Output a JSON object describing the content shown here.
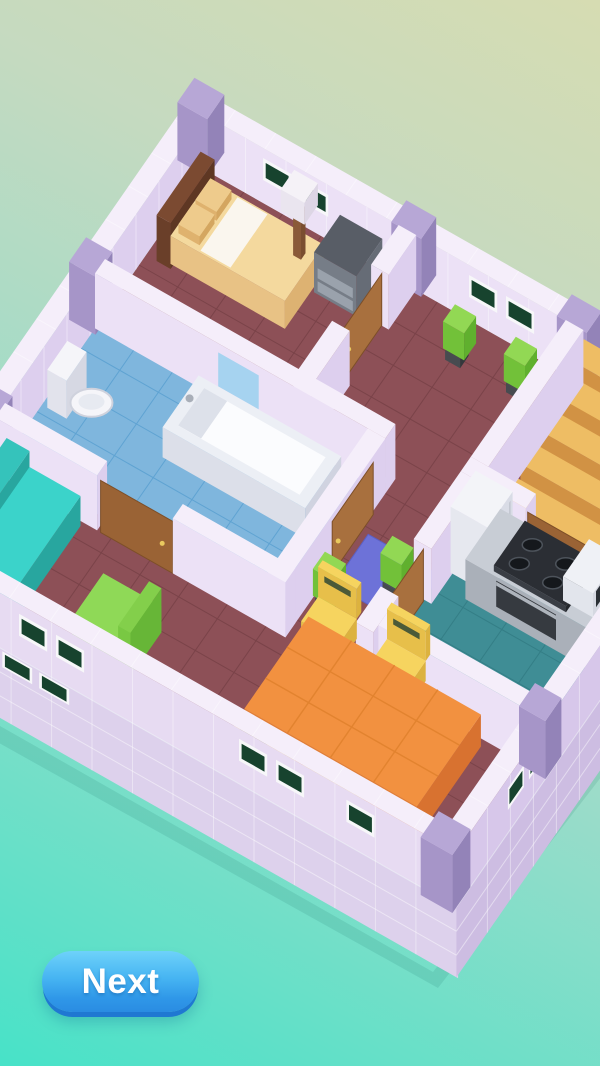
{
  "button": {
    "label": "Next",
    "text_color": "#ffffff",
    "top_color": "#6ed2fa",
    "bottom_color": "#2a8ce2",
    "shadow_color": "#1f78d2"
  },
  "background": {
    "top": "#d6dcb2",
    "mid": "#c5dac0",
    "bottom": "#47e2c8"
  },
  "scene": {
    "name": "isometric-house-floorplan",
    "objects": [
      "bed",
      "pillow",
      "table-lamp",
      "dresser",
      "door",
      "window",
      "plant",
      "stairs",
      "toilet",
      "bathtub",
      "bath-window",
      "sofa",
      "tv",
      "armchair",
      "rug",
      "fridge",
      "kitchen-counter",
      "stove",
      "microwave",
      "dining-table",
      "dining-chair"
    ],
    "colors": {
      "wallTop": "#f5eefa",
      "wallU": "#ece1f6",
      "wallV": "#ddcfee",
      "wallOuterU": "#e7dbf2",
      "wallOuterV": "#d7c7ea",
      "baseU": "#ddd1ec",
      "baseV": "#cdbde2",
      "baseLine": "rgba(255,255,255,0.45)",
      "grout": "rgba(255,255,255,0.40)",
      "capTop": "#b7a7d6",
      "capSide": "#a695c8",
      "capSideDark": "#9383b8",
      "floor": "#8d5057",
      "floorLine": "#7a4349",
      "bathFloor": "#7fb6dd",
      "bathLine": "#5fa3d2",
      "kitFloor": "#3f8d95",
      "kitLine": "#347e86",
      "windowFrame": "#f7f7f9",
      "windowGlass": "#17432e",
      "bathWindow": "#a6d3f0",
      "door": "#a8703e",
      "doorB": "#9a6335",
      "doorEdge": "#7d4f28",
      "doorHandle": "#e9c95f",
      "headboardTop": "#7b4a31",
      "headboardU": "#6a3f29",
      "headboardV": "#5e3723",
      "mattressTop": "#f4d99e",
      "mattressU": "#e8c285",
      "mattressV": "#ddb272",
      "sheet": "#faf6ee",
      "pillowTop": "#eecb8c",
      "pillowU": "#dfb26e",
      "pillowV": "#d4a660",
      "lampPole": "#8a5a38",
      "lampPoleDark": "#7a4e30",
      "lampTop": "#f5f2f7",
      "lampU": "#eae5ef",
      "lampV": "#ddd6e5",
      "dresserTop": "#585d66",
      "dresserU": "#767d87",
      "dresserV": "#666c76",
      "drawer": "#9aa2ac",
      "plantTop": "#92d854",
      "plantU": "#72c139",
      "plantV": "#60b02e",
      "plantPot": "#474b50",
      "plantPotDark": "#34383c",
      "toilet": "#f5f5f9",
      "toiletU": "#e2e3ec",
      "toiletV": "#d6d8e3",
      "toiletStroke": "#cfd2dd",
      "toiletInner": "#e7eaf1",
      "tubTop": "#eceff5",
      "tubU": "#dcdfe9",
      "tubV": "#d0d3e0",
      "tubInner": "#fbfcfe",
      "tubShadow": "#dde1ea",
      "faucet": "#a8aeb8",
      "couchTop": "#3bd3ca",
      "couchU": "#2fbab2",
      "couchV": "#28a69f",
      "couchBackTop": "#35c3bb",
      "tvTop": "#41464d",
      "tvU": "#31353b",
      "tvV": "#282c31",
      "armTop": "#8fd957",
      "armU": "#79c843",
      "armV": "#67b637",
      "armBackTop": "#83cf4b",
      "rug": "#6d72d8",
      "rugEdge": "#5b60c6",
      "fridgeTop": "#f3f4f8",
      "fridgeU": "#e6e8ef",
      "fridgeV": "#d9dce6",
      "fridgeHandle": "#c2c6d0",
      "counterTop": "#c8cdd5",
      "counterU": "#aab0b9",
      "counterV": "#9ba1ab",
      "stoveTop": "#2b2e34",
      "stoveU": "#3a3e45",
      "stoveV": "#23262b",
      "burner": "#15181c",
      "burnerRing": "#4d535b",
      "ovenDoor": "#363a40",
      "ovenHandle": "#aeb4bc",
      "microTop": "#eff1f6",
      "microU": "#e2e5ec",
      "microV": "#d5d8e1",
      "microWin": "#2b3036",
      "tableTop": "#f29140",
      "tableU": "#e37f35",
      "tableV": "#d87230",
      "tableLine": "#e2832f",
      "chairTop": "#f6d45f",
      "chairU": "#e7bf4a",
      "chairV": "#dcb23f",
      "chairSlot": "#4b5a38",
      "stairTop": "#eebd64",
      "stairU": "#d19244",
      "stairV": "#c08438",
      "shadow": "rgba(15,95,90,0.12)"
    }
  }
}
